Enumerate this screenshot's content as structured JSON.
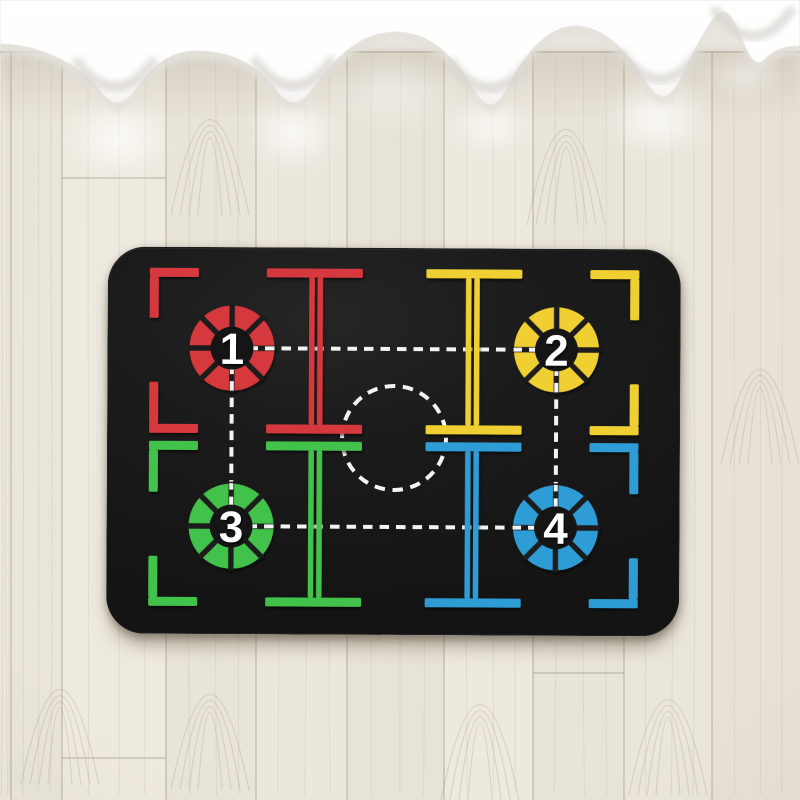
{
  "scene": {
    "floor": {
      "base_color": "#ece7dd",
      "seam_color": "rgba(148,138,120,0.5)",
      "grain_color": "rgba(170,158,138,0.3)",
      "plank_boundaries": [
        0,
        11,
        62,
        166,
        256,
        347,
        444,
        533,
        624,
        712,
        800
      ],
      "plank_tints": [
        "#ede8de",
        "#eae5da",
        "#efeae0",
        "#e9e4d8",
        "#ece7dd",
        "#e8e3d7",
        "#eee9df",
        "#e9e4d9",
        "#ebe6db",
        "#e8e2d6"
      ],
      "joints": [
        {
          "x1": 62,
          "x2": 166,
          "y": 758
        },
        {
          "x1": 533,
          "x2": 624,
          "y": 673
        },
        {
          "x1": 62,
          "x2": 166,
          "y": 178
        }
      ],
      "grain_features": [
        {
          "x": 210,
          "y": 130
        },
        {
          "x": 566,
          "y": 140
        },
        {
          "x": 760,
          "y": 380
        },
        {
          "x": 210,
          "y": 705
        },
        {
          "x": 668,
          "y": 710
        },
        {
          "x": 480,
          "y": 715
        },
        {
          "x": 60,
          "y": 700
        }
      ],
      "wall_line_y": 52
    },
    "curtain": {
      "color": "#fdfdfd",
      "under_color": "#e4e1db",
      "fold_color": "#d9d6d0",
      "panel_path": "M0,0 L800,0 L800,46 C786,46 775,49 766,58 Q759,66 753,60 C744,50 739,26 729,15 Q723,8 715,17 C703,31 690,60 677,85 Q663,108 649,86 C632,59 609,27 576,26 C544,26 521,60 503,95 Q490,115 477,94 C459,63 434,32 396,32 C359,32 334,59 310,92 Q294,113 278,92 C258,64 230,51 196,51 C173,51 155,62 134,91 Q118,114 102,93 C82,67 45,45 0,44 Z",
      "dips": [
        {
          "x": 115,
          "y": 111
        },
        {
          "x": 293,
          "y": 110
        },
        {
          "x": 490,
          "y": 112
        },
        {
          "x": 660,
          "y": 103
        },
        {
          "x": 753,
          "y": 60
        }
      ],
      "glows": [
        {
          "x": 118,
          "y": 138,
          "rx": 50,
          "ry": 40,
          "o": 0.85
        },
        {
          "x": 293,
          "y": 133,
          "rx": 45,
          "ry": 38,
          "o": 0.85
        },
        {
          "x": 490,
          "y": 125,
          "rx": 40,
          "ry": 32,
          "o": 0.7
        },
        {
          "x": 658,
          "y": 118,
          "rx": 52,
          "ry": 42,
          "o": 0.85
        },
        {
          "x": 395,
          "y": 92,
          "rx": 75,
          "ry": 40,
          "o": 0.5
        },
        {
          "x": 745,
          "y": 75,
          "rx": 38,
          "ry": 24,
          "o": 0.5
        }
      ]
    },
    "mat": {
      "x": 107,
      "y": 248,
      "w": 571,
      "h": 385,
      "radius": 38,
      "surface_color": "#1a1a1a",
      "disc_color": "#151515",
      "dash_color": "#f3f3f3",
      "mirror_cx": 285.75,
      "mirror_cy": 189,
      "center_circle": {
        "cx": 286,
        "cy": 189,
        "r": 52
      },
      "wheel": {
        "outer_r": 42.5,
        "inner_r": 21,
        "ring_stroke": 21.5,
        "ring_r": 31.75,
        "disc_r": 21.5,
        "spoke_w": 5.5,
        "spoke_r0": 16.5,
        "spoke_r1": 44.5
      },
      "quad_rects": [
        [
          41,
          20,
          49,
          9
        ],
        [
          41,
          29,
          9,
          41
        ],
        [
          41,
          134,
          9,
          42
        ],
        [
          41,
          176,
          49,
          9
        ],
        [
          158,
          20,
          96,
          9
        ],
        [
          158,
          176,
          96,
          9
        ],
        [
          200.5,
          29,
          5.5,
          147
        ],
        [
          208.8,
          29,
          5.5,
          147
        ]
      ],
      "quadrants": [
        {
          "name": "red",
          "mx": false,
          "my": false,
          "color": "#d5393d"
        },
        {
          "name": "yellow",
          "mx": true,
          "my": false,
          "color": "#efcf31"
        },
        {
          "name": "green",
          "mx": false,
          "my": true,
          "color": "#43c14b"
        },
        {
          "name": "blue",
          "mx": true,
          "my": true,
          "color": "#2d9cd5"
        }
      ],
      "circles": [
        {
          "label": "1",
          "color": "#d5393d",
          "cx": 123.5,
          "cy": 100
        },
        {
          "label": "2",
          "color": "#efcf31",
          "cx": 448,
          "cy": 100
        },
        {
          "label": "3",
          "color": "#43c14b",
          "cx": 123.5,
          "cy": 278
        },
        {
          "label": "4",
          "color": "#2d9cd5",
          "cx": 448,
          "cy": 278
        }
      ],
      "dash_lines": [
        [
          123.5,
          100,
          448,
          100
        ],
        [
          123.5,
          278,
          448,
          278
        ],
        [
          123.5,
          100,
          123.5,
          278
        ],
        [
          448,
          100,
          448,
          278
        ]
      ],
      "number_font_size": 44
    }
  }
}
